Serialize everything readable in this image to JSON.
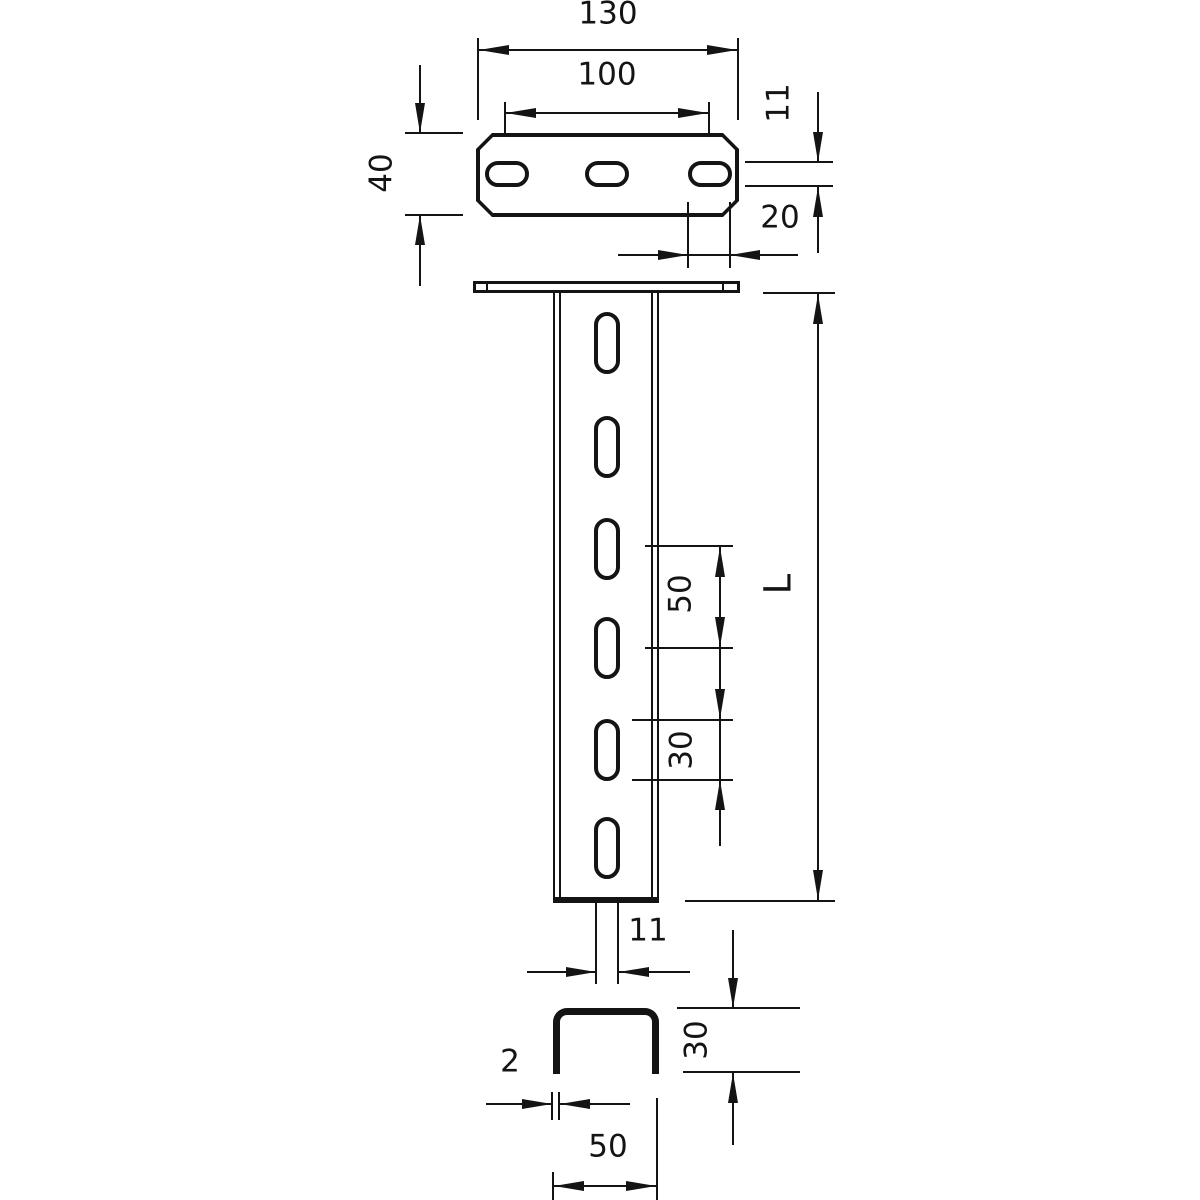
{
  "drawing": {
    "ink_color": "#141414",
    "paper_color": "#ffffff",
    "views": {
      "head_plate_top": {
        "name": "head plate top view",
        "dims": {
          "overall_width": "130",
          "hole_pitch": "100",
          "plate_depth": "40",
          "slot_height": "11",
          "slot_length": "20"
        }
      },
      "support_front": {
        "name": "support front view",
        "dims": {
          "length": "L",
          "slot_pitch": "50",
          "slot_length": "30",
          "slot_width": "11"
        }
      },
      "profile_section": {
        "name": "profile cross section",
        "dims": {
          "profile_width": "50",
          "profile_height": "30",
          "material_thickness": "2"
        }
      }
    }
  }
}
